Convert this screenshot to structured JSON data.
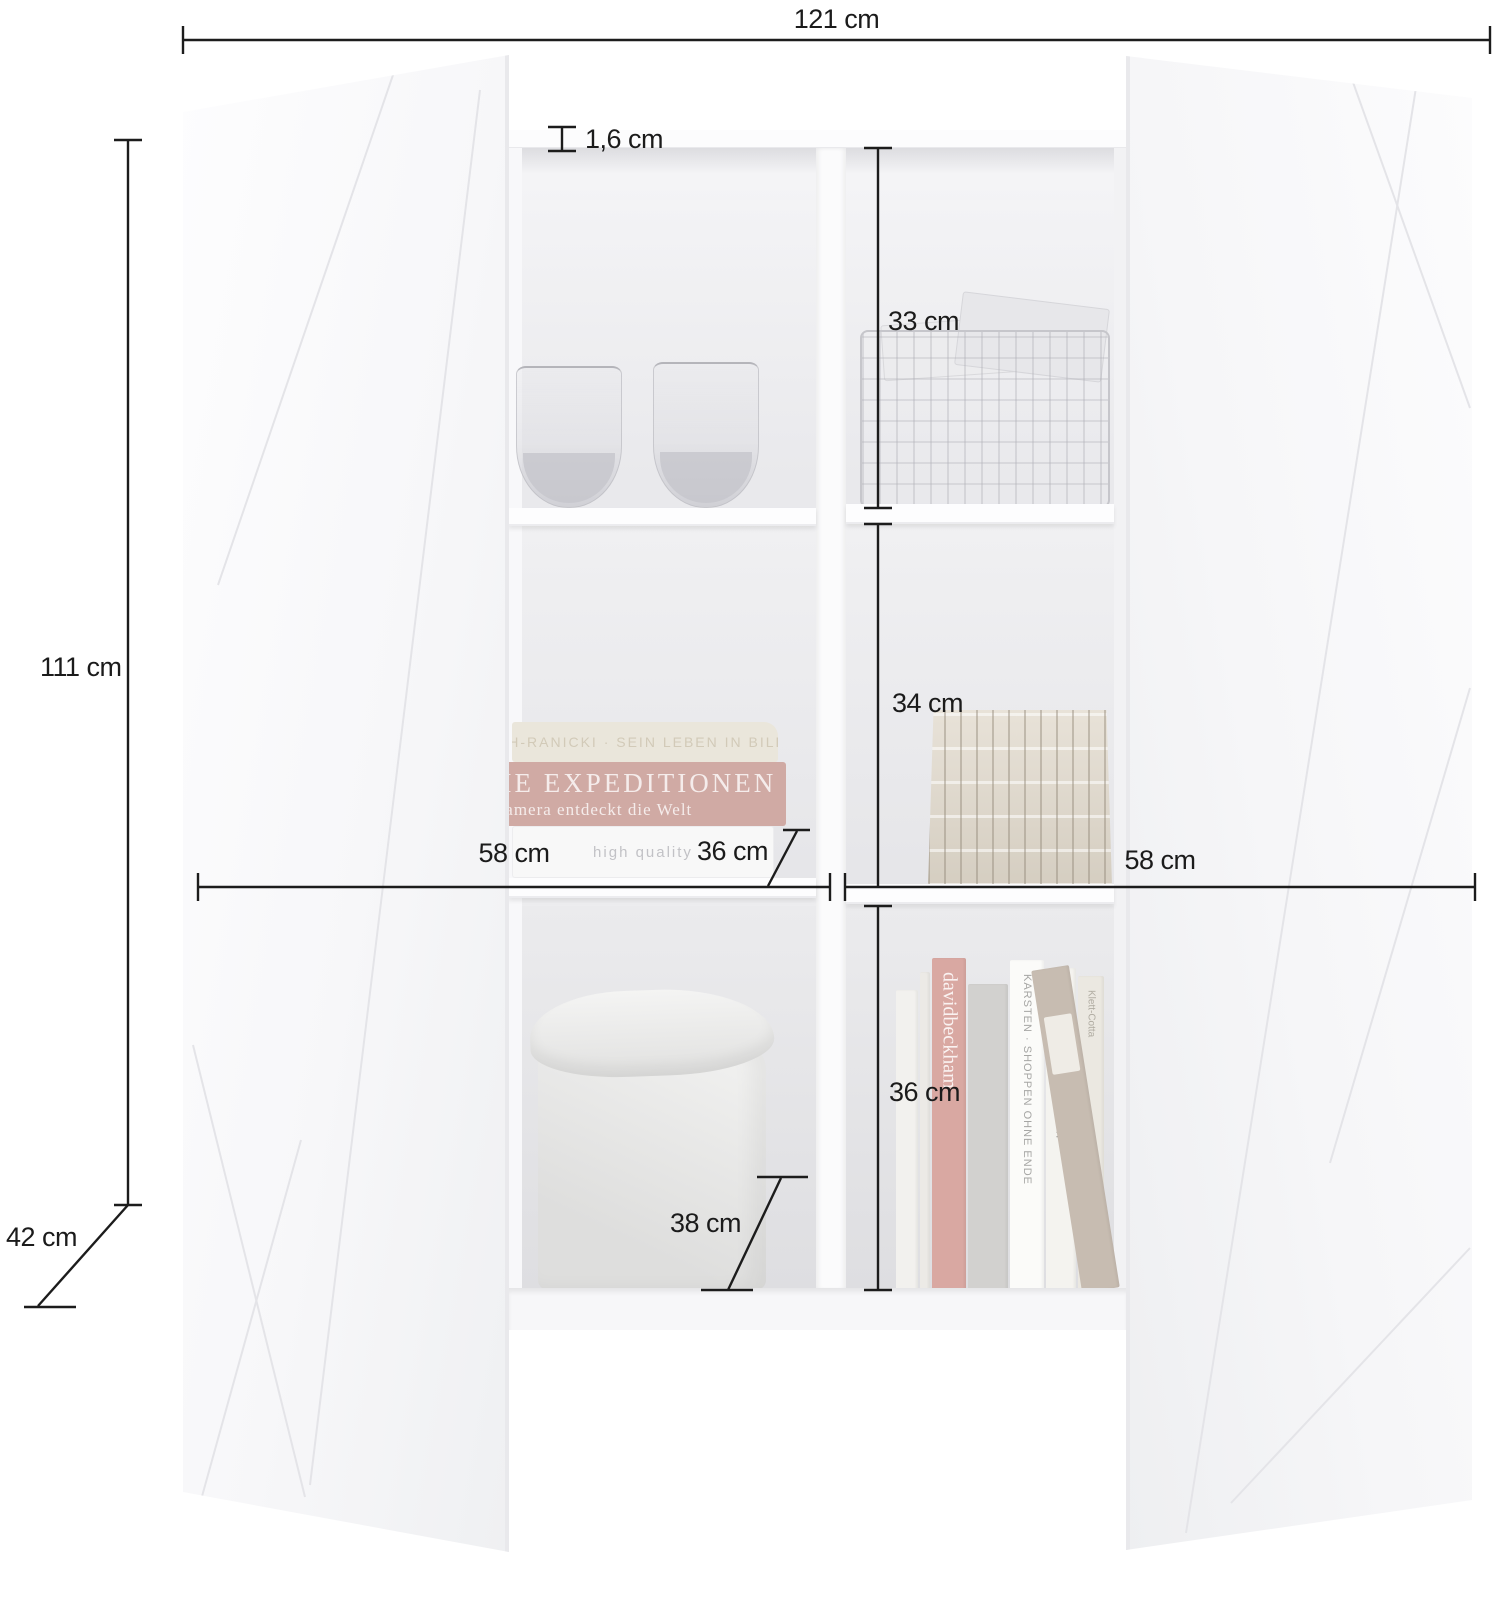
{
  "meta": {
    "kind": "furniture dimension diagram",
    "unit": "cm",
    "annotation_color": "#1b1b1b"
  },
  "dimensions": {
    "total_width": "121 cm",
    "panel_thickness": "1,6 cm",
    "total_height": "111 cm",
    "total_depth": "42 cm",
    "top_compartment_height": "33 cm",
    "middle_compartment_height": "34 cm",
    "bottom_compartment_height": "36 cm",
    "left_compartment_width": "58 cm",
    "right_compartment_width": "58 cm",
    "middle_compartment_depth": "36 cm",
    "bottom_compartment_depth": "38 cm"
  },
  "props": {
    "stacked_books": {
      "top_spine": "Reich-Ranicki · Sein Leben in Bildern",
      "middle_spine_line1": "DIE EXPEDITIONEN",
      "middle_spine_line2": "Kamera entdeckt die Welt",
      "bottom_spine": "high quality"
    },
    "standing_books": {
      "spine_beckham": "davidbeckham",
      "spine_karsten": "KARSTEN · SHOPPEN OHNE ENDE",
      "spine_amos": "Amos Oz · Unter Freunden",
      "spine_klett": "Klett-Cotta"
    }
  }
}
